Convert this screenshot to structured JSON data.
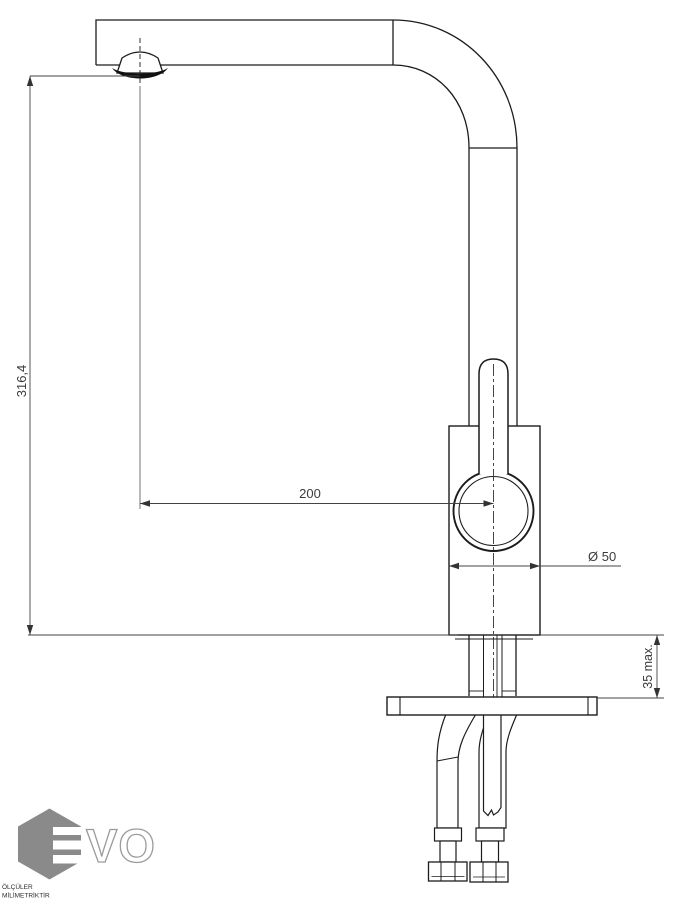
{
  "drawing": {
    "title": "kitchen-mixer-tap-technical-drawing",
    "dimensions": {
      "height_label": "316,4",
      "reach_label": "200",
      "diameter_label": "Ø 50",
      "mount_label": "35 max."
    },
    "notes": {
      "line1": "ÖLÇÜLER",
      "line2": "MİLİMETRİKTİR"
    }
  },
  "logo": {
    "text": "VO"
  },
  "colors": {
    "line": "#1c1c1c",
    "dimension_line": "#444444",
    "dimension_text": "#3c3c3c",
    "logo_gray": "#8a8a8a",
    "background": "#ffffff"
  }
}
